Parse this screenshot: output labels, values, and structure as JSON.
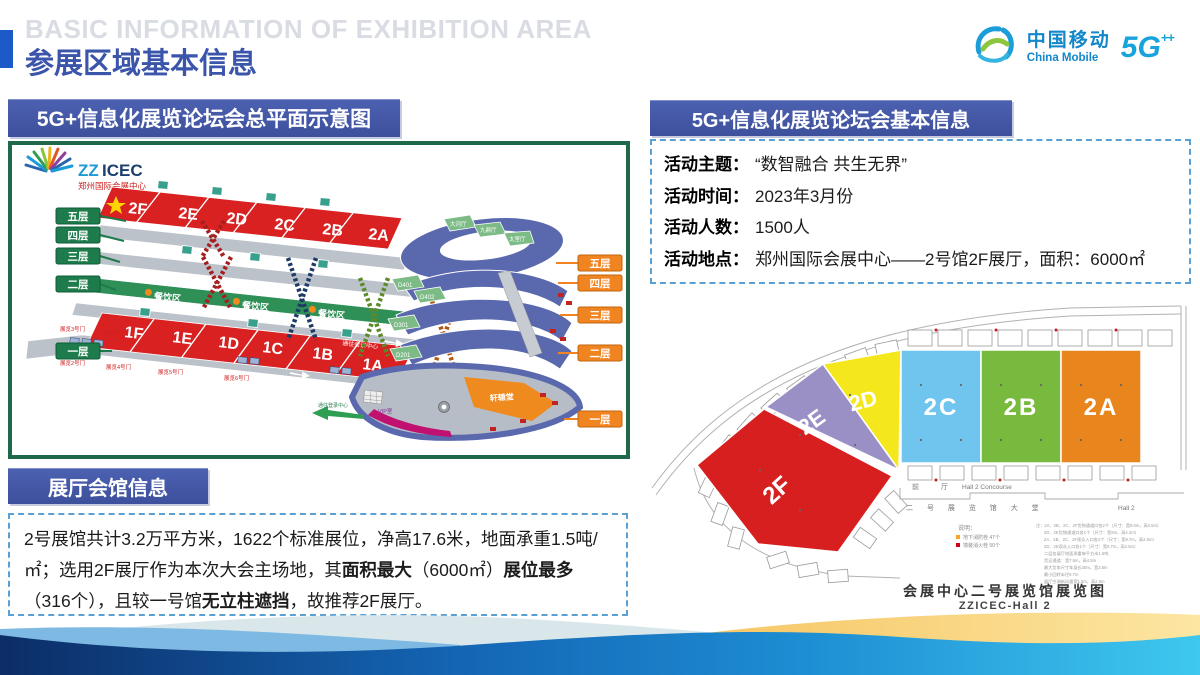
{
  "header": {
    "title_en": "BASIC INFORMATION OF EXHIBITION AREA",
    "title_zh": "参展区域基本信息"
  },
  "brand": {
    "zh": "中国移动",
    "en": "China Mobile",
    "badge": "5G",
    "badge_sup": "++"
  },
  "overview": {
    "banner": "5G+信息化展览论坛会总平面示意图",
    "venue_logo": {
      "prefix": "ZZ",
      "rest": "ICEC",
      "subtitle": "郑州国际会展中心"
    },
    "floor_tags_left": [
      "五层",
      "四层",
      "三层",
      "二层",
      "一层"
    ],
    "floor_tags_right": [
      "五层",
      "四层",
      "三层",
      "二层",
      "一层"
    ],
    "halls_level2": [
      "2F",
      "2E",
      "2D",
      "2C",
      "2B",
      "2A"
    ],
    "halls_level1": [
      "1F",
      "1E",
      "1D",
      "1C",
      "1B",
      "1A"
    ],
    "dining": "餐饮区",
    "corridor": "通往会议中心",
    "corridor2": "通往登录中心",
    "rooms": {
      "r1": "大河厅",
      "r2": "九鼎厅",
      "r3": "太室厅",
      "d401": "D401",
      "d402": "D402",
      "d301": "D301",
      "d201": "D201",
      "hall": "轩辕堂",
      "vip": "VIP室"
    },
    "doors": [
      "展览3号门",
      "展览5号门",
      "展览2号门",
      "展览4号门",
      "展览5号门",
      "展览6号门"
    ]
  },
  "hall_info": {
    "banner": "展厅会馆信息",
    "paragraph": [
      {
        "t": "2号展馆共计3.2万平方米，1622个标准展位，净高17.6米，地面承重1.5吨/㎡；选用2F展厅作为本次大会主场地，其"
      },
      {
        "t": "面积最大",
        "b": true
      },
      {
        "t": "（6000㎡）"
      },
      {
        "t": "展位最多",
        "b": true
      },
      {
        "t": "（316个），且较一号馆"
      },
      {
        "t": "无立柱遮挡",
        "b": true
      },
      {
        "t": "，故推荐2F展厅。"
      }
    ]
  },
  "basic_info": {
    "banner": "5G+信息化展览论坛会基本信息",
    "rows": [
      {
        "label": "活动主题：",
        "value": "“数智融合 共生无界”"
      },
      {
        "label": "活动时间：",
        "value": "2023年3月份"
      },
      {
        "label": "活动人数：",
        "value": "1500人"
      },
      {
        "label": "活动地点：",
        "value": "郑州国际会展中心——2号馆2F展厅，面积：6000㎡"
      }
    ]
  },
  "hall2_plan": {
    "sections": [
      {
        "label": "2F",
        "color": "#d81f1f"
      },
      {
        "label": "2E",
        "color": "#9a90c6"
      },
      {
        "label": "2D",
        "color": "#f4e81c"
      },
      {
        "label": "2C",
        "color": "#6fc5ed"
      },
      {
        "label": "2B",
        "color": "#77ba3d"
      },
      {
        "label": "2A",
        "color": "#e8851d"
      }
    ],
    "concourse_zh": "前 厅",
    "concourse_en": "Hall 2 Concourse",
    "lobby_zh": "二 号 展 览 馆 大 堂",
    "lobby_en": "Hall 2",
    "legend_title": "说明：",
    "legend": [
      {
        "swatch": "#f5a623",
        "text": "地下消防栓 47个"
      },
      {
        "swatch": "#d0021b",
        "text": "墙装消火栓 50个"
      }
    ],
    "notes": [
      "注：2A、2B、2C、2F货物通道口各2个（尺寸：宽9.0m，高4.5m）",
      "2D、2E货物通道口各1个（尺寸：宽9m，高4.2m）",
      "2A、2B、2C、2F观众入口各2个（尺寸：宽9.7m，高2.5m）",
      "2D、2E观众入口各1个（尺寸：宽9.7m，高2.5m）",
      "二层各展厅地面承重每平方米1.5吨",
      "货运通道：宽7.5m，高4.5m",
      "最大货车尺寸车身长20m，宽3.5m",
      "最小回转半径9.7m",
      "展厅空调新风量宽1.5m，高2.5m"
    ],
    "caption_zh": "会展中心二号展览馆展览图",
    "caption_en": "ZZICEC-Hall 2"
  },
  "palette": {
    "accent_blue": "#1c5ac8",
    "banner_indigo": "#41549e",
    "plan_border_green": "#20684a",
    "dashed_blue": "#58a0d6",
    "halls_red": "#d92121",
    "floor_tag_green": "#1e7b4b",
    "floor_tag_orange": "#ef8420",
    "dining_green": "#2e8f57",
    "ring_blue": "#5a69ae"
  }
}
